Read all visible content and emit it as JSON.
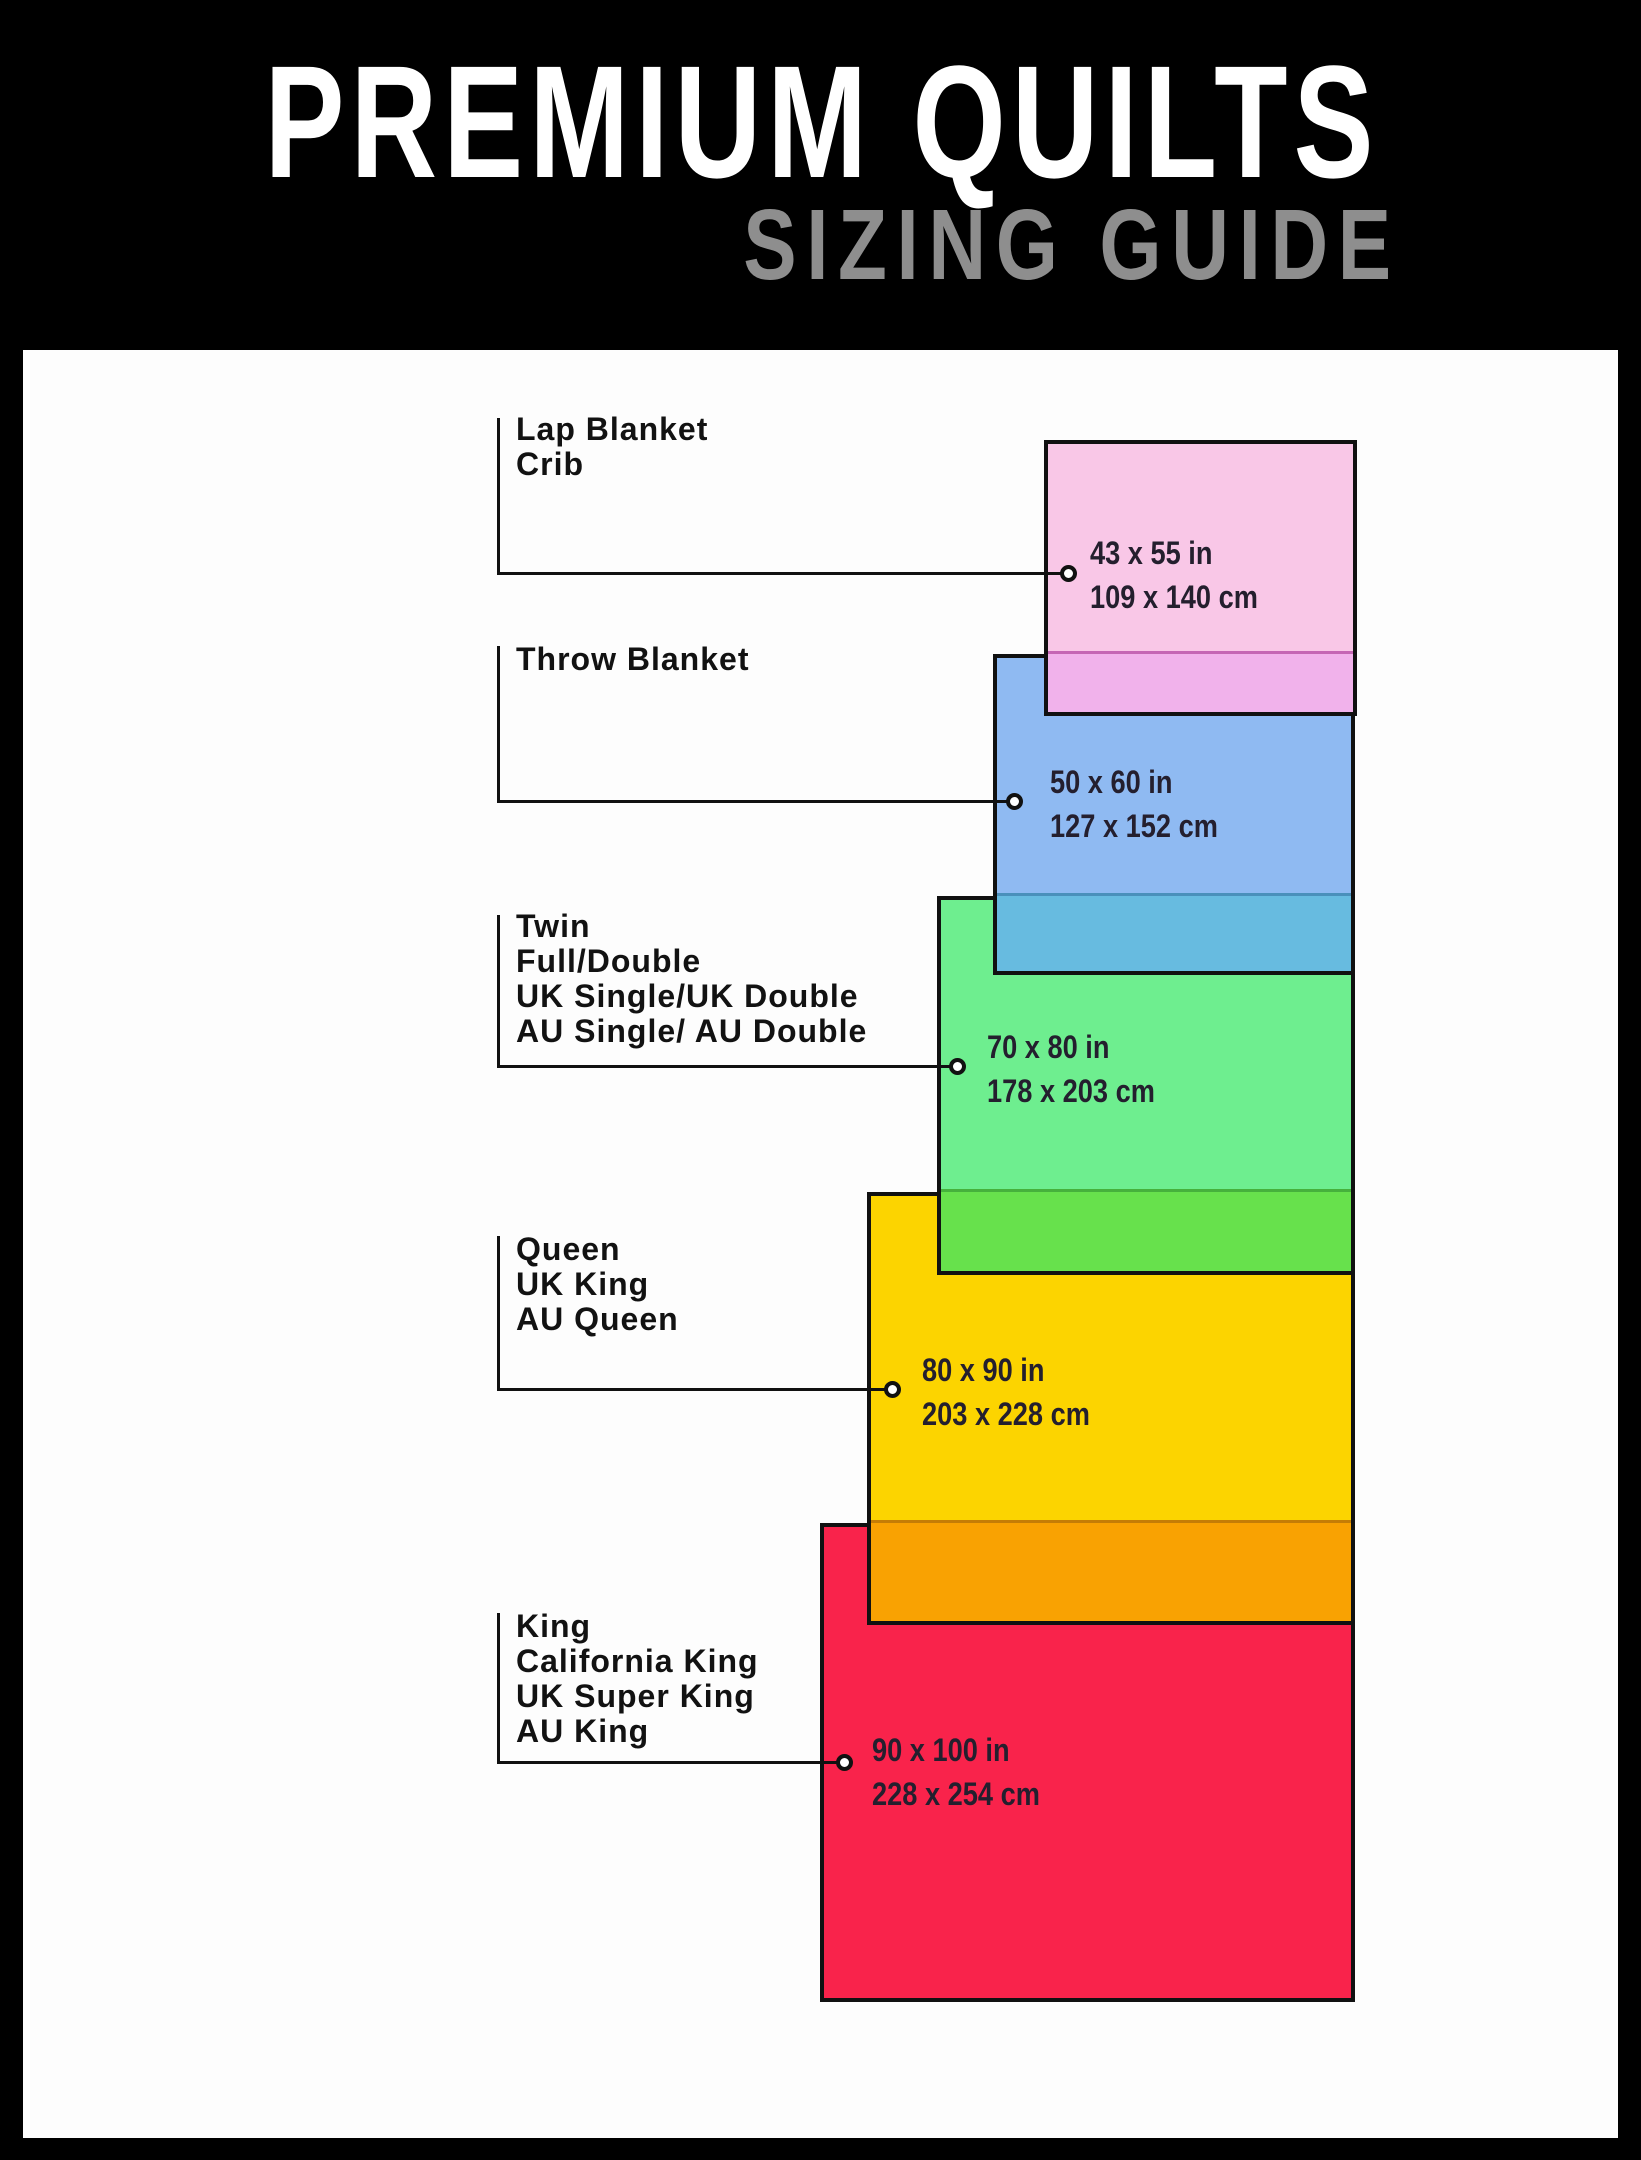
{
  "header": {
    "title": "PREMIUM QUILTS",
    "subtitle": "SIZING GUIDE",
    "title_color": "#ffffff",
    "subtitle_color": "#8e8e8e",
    "background": "#000000"
  },
  "sizes": [
    {
      "id": "lap-blanket-crib",
      "labels": [
        "Lap Blanket",
        "Crib"
      ],
      "inches": "43 x 55 in",
      "cm": "109 x 140 cm",
      "fill": "#f9c7e7",
      "overlap_fill": "#f1b2eb",
      "border": "#111111"
    },
    {
      "id": "throw-blanket",
      "labels": [
        "Throw Blanket"
      ],
      "inches": "50 x 60 in",
      "cm": "127 x 152 cm",
      "fill": "#8fbaf2",
      "overlap_fill": "#67bbe0",
      "border": "#111111"
    },
    {
      "id": "twin-full-double",
      "labels": [
        "Twin",
        "Full/Double",
        "UK Single/UK Double",
        "AU Single/ AU Double"
      ],
      "inches": "70 x 80 in",
      "cm": "178 x 203 cm",
      "fill": "#6eee8f",
      "overlap_fill": "#67e14c",
      "border": "#111111"
    },
    {
      "id": "queen-uk-king-au-queen",
      "labels": [
        "Queen",
        "UK King",
        "AU Queen"
      ],
      "inches": "80 x 90 in",
      "cm": "203 x 228 cm",
      "fill": "#fcd400",
      "overlap_fill": "#f9a202",
      "border": "#111111"
    },
    {
      "id": "king-california-king",
      "labels": [
        "King",
        "California King",
        "UK Super King",
        "AU King"
      ],
      "inches": "90 x 100 in",
      "cm": "228 x 254 cm",
      "fill": "#f9234b",
      "overlap_fill": null,
      "border": "#111111"
    }
  ]
}
